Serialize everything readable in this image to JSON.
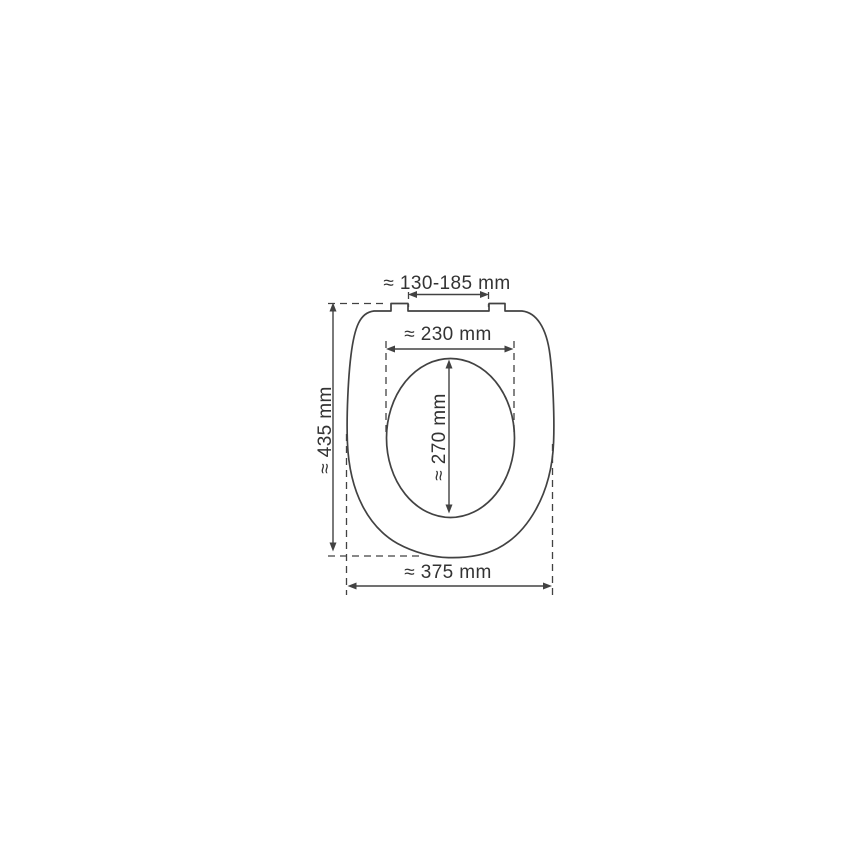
{
  "canvas": {
    "width": 868,
    "height": 868,
    "background": "#ffffff"
  },
  "diagram": {
    "subject": "toilet-seat-top-view-dimension-drawing",
    "colors": {
      "line": "#424242",
      "text": "#333333",
      "background": "#ffffff"
    },
    "labels": {
      "hinge_spacing": "≈ 130-185 mm",
      "inner_width": "≈ 230 mm",
      "inner_depth": "≈ 270 mm",
      "overall_depth": "≈ 435 mm",
      "overall_width": "≈ 375 mm"
    },
    "values_mm": {
      "hinge_spacing_min": 130,
      "hinge_spacing_max": 185,
      "inner_width": 230,
      "inner_depth": 270,
      "overall_depth": 435,
      "overall_width": 375
    }
  }
}
